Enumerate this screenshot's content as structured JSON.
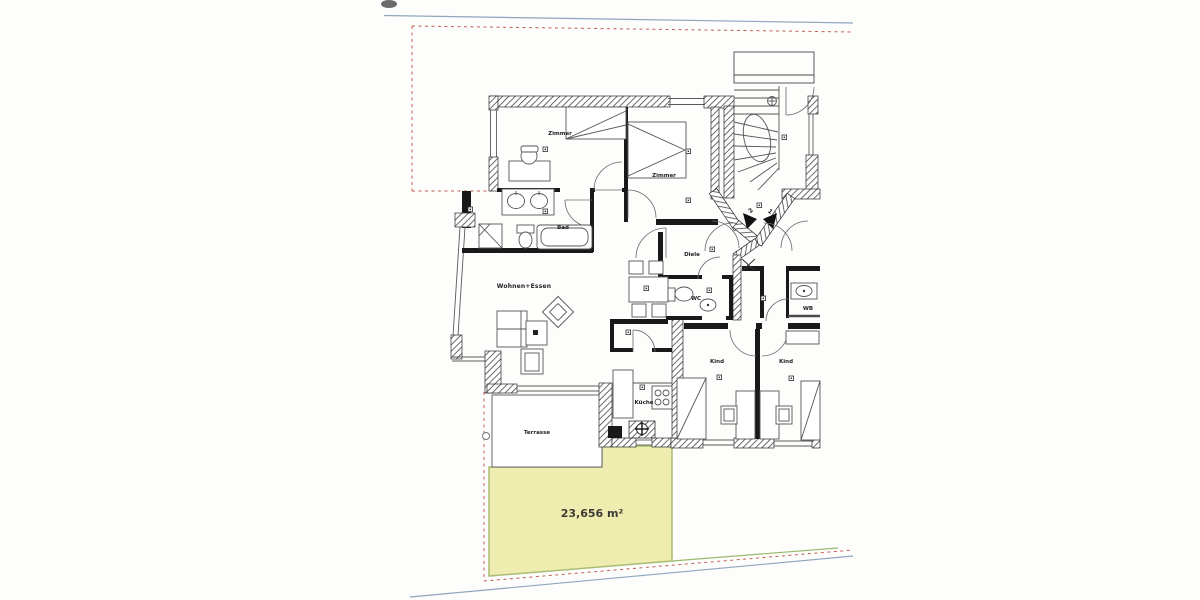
{
  "plan": {
    "rooms": {
      "zimmer1": "Zimmer",
      "zimmer2": "Zimmer",
      "bad": "Bad",
      "wohnen_essen": "Wohnen+Essen",
      "diele": "Diele",
      "wc": "WC",
      "kueche": "Küche",
      "kind1": "Kind",
      "kind2": "Kind",
      "terrasse": "Terrasse",
      "wb": "WB"
    },
    "garden": {
      "area_label": "23,656 m²",
      "fill": "#efecb0",
      "border": "#a9bc74"
    },
    "entry": {
      "door1": "1",
      "door2": "2"
    },
    "boundary": {
      "dash_color": "#c2604f",
      "line_color": "#8fa6bd",
      "green_color": "#9cb96e"
    },
    "icons": {
      "room_marker": "small-square-with-dot",
      "survey_cross": "x-mark",
      "stair_circle": "circle-plus-marker"
    }
  }
}
